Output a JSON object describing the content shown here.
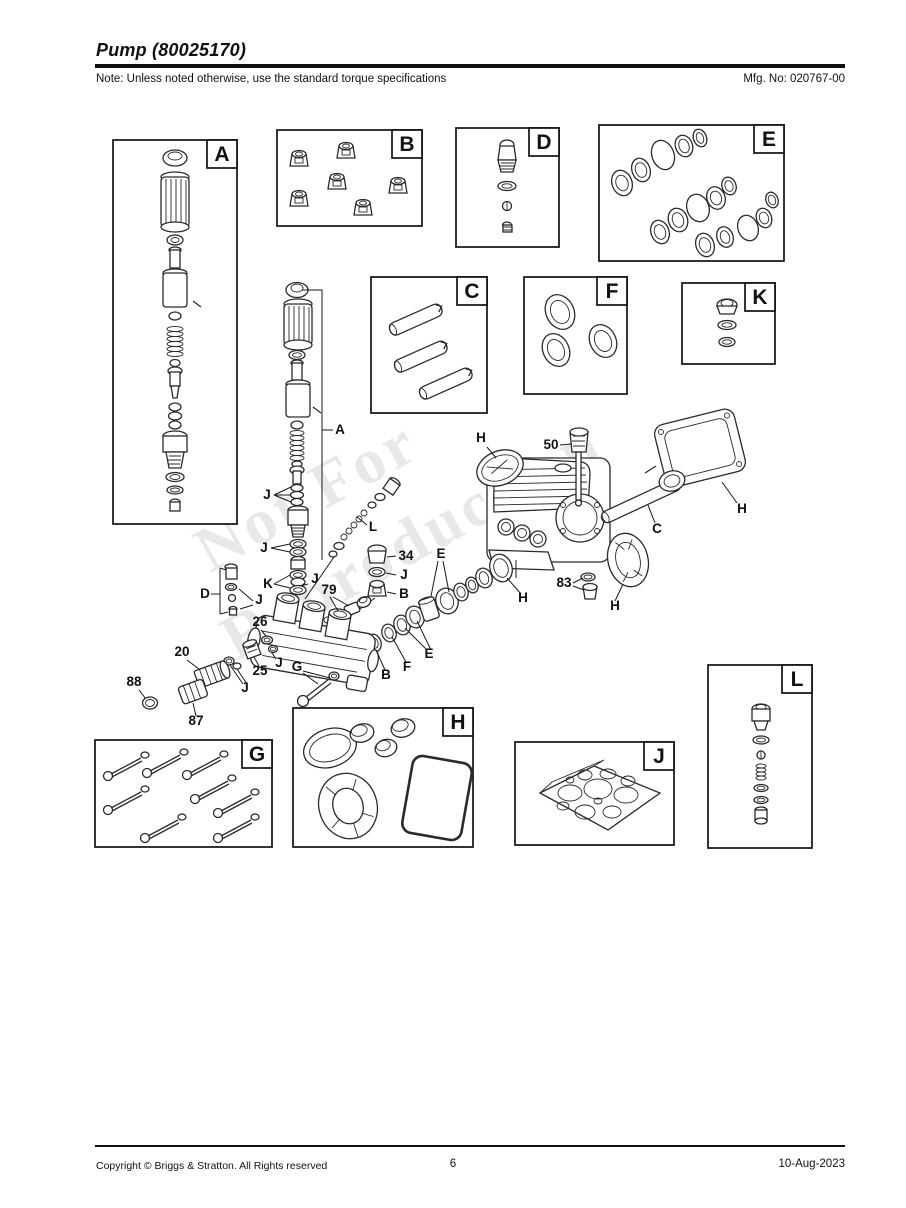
{
  "header": {
    "title": "Pump (80025170)",
    "note": "Note: Unless noted otherwise, use the standard torque specifications",
    "mfg_no": "Mfg. No: 020767-00"
  },
  "footer": {
    "copyright": "Copyright ©  Briggs & Stratton. All Rights reserved",
    "page_number": "6",
    "date": "10-Aug-2023"
  },
  "watermark": {
    "line1": "Not For",
    "line2": "Reproduction"
  },
  "insets": {
    "a": "A",
    "b": "B",
    "c": "C",
    "d": "D",
    "e": "E",
    "f": "F",
    "g": "G",
    "h": "H",
    "j": "J",
    "k": "K",
    "l": "L"
  },
  "callouts": [
    "A",
    "H",
    "50",
    "H",
    "C",
    "J",
    "J",
    "L",
    "34",
    "J",
    "B",
    "K",
    "J",
    "79",
    "D",
    "J",
    "26",
    "20",
    "25",
    "J",
    "J",
    "88",
    "87",
    "G",
    "E",
    "H",
    "83",
    "H",
    "E",
    "F",
    "B"
  ]
}
